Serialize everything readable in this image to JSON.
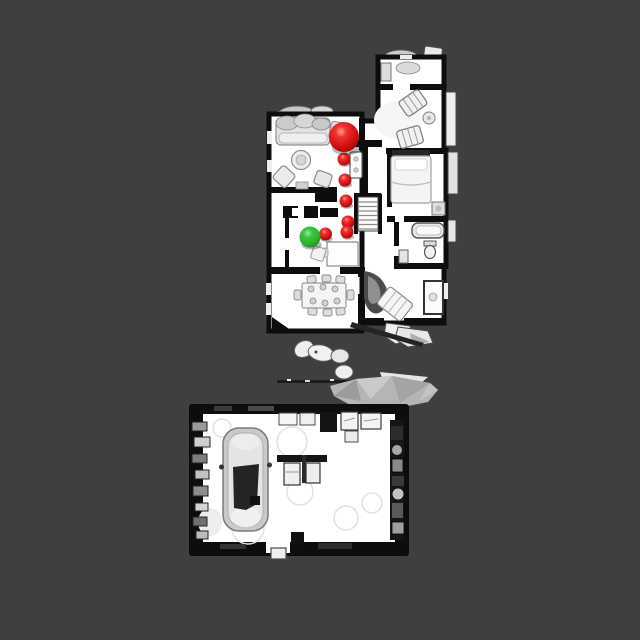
{
  "scene": {
    "description": "Top-down orthographic render of a scanned two-building home (house above, garage with car below) with navigation markers",
    "background_color": "#3f3f3f",
    "floor_color": "#ffffff",
    "wall_color": "#0d0d0d",
    "mesh_gray": "#b5b5b5",
    "goal_color_red": "#d31414",
    "agent_color_green": "#2eb32e"
  },
  "markers": {
    "goal": {
      "kind": "goal-sphere-red",
      "x": 344,
      "y": 137,
      "r": 15
    },
    "agent": {
      "kind": "agent-sphere-green",
      "x": 310,
      "y": 237,
      "r": 10.5
    },
    "waypoints": [
      {
        "x": 344,
        "y": 159,
        "r": 6.5
      },
      {
        "x": 345,
        "y": 180,
        "r": 6.5
      },
      {
        "x": 346,
        "y": 201,
        "r": 6.5
      },
      {
        "x": 348,
        "y": 222,
        "r": 6.5
      },
      {
        "x": 347,
        "y": 232,
        "r": 6.5
      },
      {
        "x": 325.5,
        "y": 234,
        "r": 6.5
      }
    ]
  }
}
